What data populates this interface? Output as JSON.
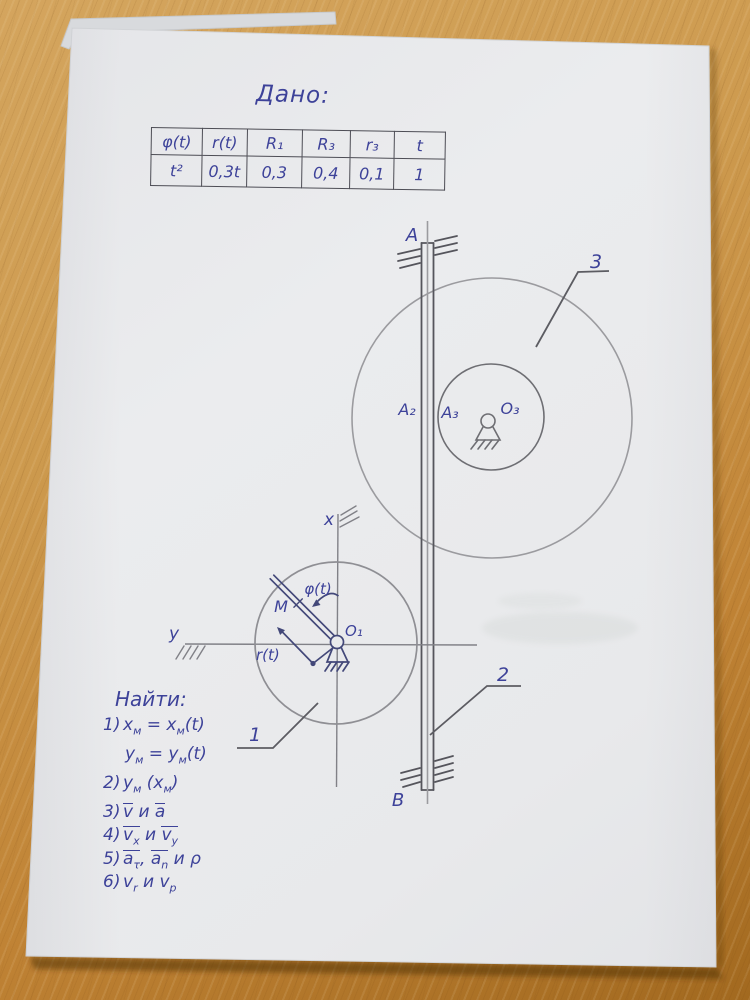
{
  "page": {
    "given_label": "Дано:",
    "find_label": "Найти:"
  },
  "table": {
    "headers": [
      "φ(t)",
      "r(t)",
      "R₁",
      "R₃",
      "r₃",
      "t"
    ],
    "values": [
      "t²",
      "0,3t",
      "0,3",
      "0,4",
      "0,1",
      "1"
    ]
  },
  "find": {
    "items": [
      {
        "num": "1)",
        "html": "x<sub>м</sub> = x<sub>м</sub>(t)"
      },
      {
        "num": "",
        "html": "y<sub>м</sub> = y<sub>м</sub>(t)"
      },
      {
        "num": "2)",
        "html": "y<sub>м</sub> (x<sub>м</sub>)"
      },
      {
        "num": "3)",
        "html": "<span class='bar'>v</span> и <span class='bar'>a</span>"
      },
      {
        "num": "4)",
        "html": "<span class='bar'>v<sub>x</sub></span> и <span class='bar'>v<sub>y</sub></span>"
      },
      {
        "num": "5)",
        "html": "<span class='bar'>a<sub>τ</sub></span>, <span class='bar'>a<sub>n</sub></span> и ρ"
      },
      {
        "num": "6)",
        "html": "v<sub>r</sub> и v<sub>p</sub>"
      }
    ]
  },
  "diagram": {
    "labels": {
      "guide_top": "A",
      "guide_bottom": "B",
      "body_1": "1",
      "body_2": "2",
      "body_3": "3",
      "contact_rack": "A₂",
      "contact_wheel3": "A₃",
      "center_wheel3": "O₃",
      "center_wheel1": "O₁",
      "axis_x": "x",
      "axis_y": "y",
      "point_m": "M",
      "angle": "φ(t)",
      "radius": "r(t)"
    }
  }
}
